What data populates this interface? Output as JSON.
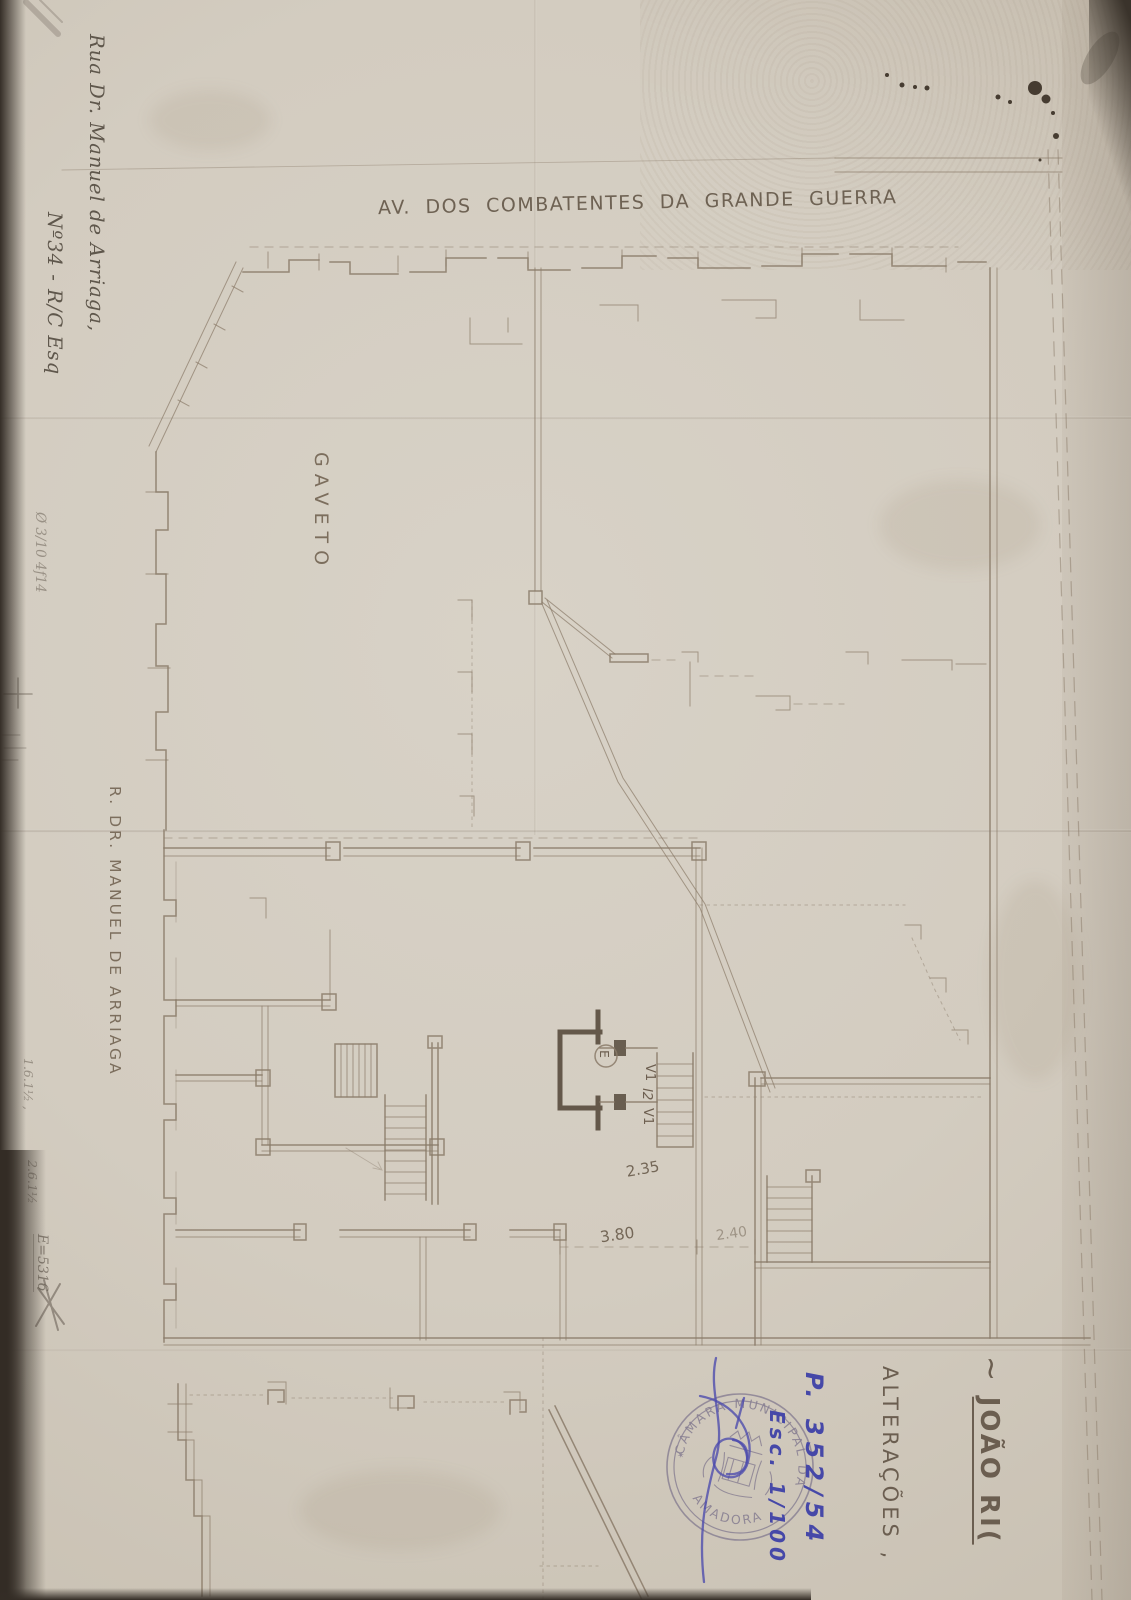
{
  "page": {
    "street_top": "AV. DOS COMBATENTES DA GRANDE GUERRA",
    "corner": "GAVETO",
    "street_left": "R. DR. MANUEL DE ARRIAGA",
    "address": {
      "line1": "Rua Dr. Manuel de Arriaga,",
      "line2": "Nº34 - R/C Esq"
    },
    "title": {
      "tilde": "~ ",
      "name": "JOÃO RI(",
      "subtitle": "ALTERAÇÕES ,"
    },
    "blue_notes": {
      "process": "P. 352/54",
      "scale": "Esc. 1/100"
    },
    "stamp": {
      "arc_top": "CÂMARA MUNICIPAL DA",
      "arc_bottom": "AMADORA",
      "star": "✶"
    },
    "plan": {
      "v1_top": "V1",
      "l2": "l2",
      "v1_bottom": "V1",
      "elevator": "E",
      "dim_entry": "2.35",
      "dim_left": "3.80",
      "dim_right": "2.40"
    },
    "margins": {
      "upper_left": "Ø 3/10 4f14",
      "lower_1": "1.6.1½ ,",
      "lower_2": "2.6.1½",
      "lower_3": "E=5316"
    },
    "colors": {
      "paper": "#d3ccc0",
      "plan_line": "#8a7a68",
      "pencil": "#6a6156",
      "blue_ink": "#4648a8",
      "stamp": "#867d91",
      "scan_bg": "#453e36"
    }
  }
}
